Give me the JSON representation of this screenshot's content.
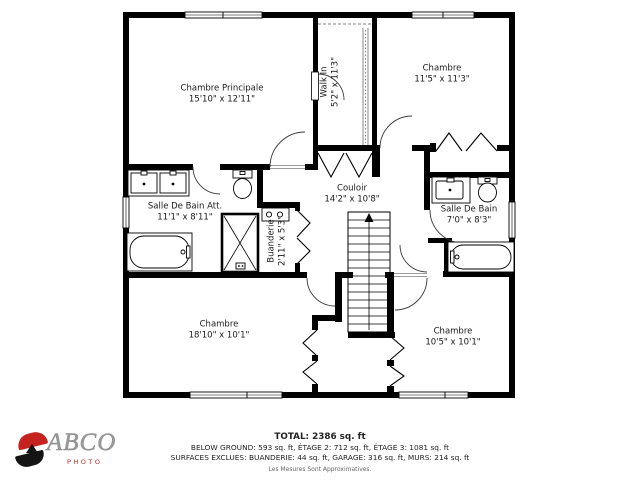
{
  "floor_plan": {
    "rooms": [
      {
        "id": "master-bedroom",
        "name": "Chambre Principale",
        "dims": "15'10\" x 12'11\""
      },
      {
        "id": "walk-in-closet",
        "name": "Walk In",
        "dims": "5'2\" x 11'3\""
      },
      {
        "id": "bedroom-top-right",
        "name": "Chambre",
        "dims": "11'5\" x 11'3\""
      },
      {
        "id": "ensuite-bathroom",
        "name": "Salle De Bain Att.",
        "dims": "11'1\" x 8'11\""
      },
      {
        "id": "hallway",
        "name": "Couloir",
        "dims": "14'2\" x 10'8\""
      },
      {
        "id": "bathroom",
        "name": "Salle De Bain",
        "dims": "7'0\" x 8'3\""
      },
      {
        "id": "laundry",
        "name": "Buanderie",
        "dims": "2'11\" x 5'3\""
      },
      {
        "id": "bedroom-bottom-left",
        "name": "Chambre",
        "dims": "18'10\" x 10'1\""
      },
      {
        "id": "bedroom-bottom-right",
        "name": "Chambre",
        "dims": "10'5\" x 10'1\""
      }
    ]
  },
  "footer": {
    "total": "TOTAL: 2386 sq. ft",
    "line2": "BELOW GROUND: 593 sq. ft, ÉTAGE 2: 712 sq. ft, ÉTAGE 3: 1081 sq. ft",
    "line3": "SURFACES EXCLUES: BUANDERIE: 44 sq. ft, GARAGE: 316 sq. ft, MURS: 214 sq. ft",
    "disclaimer": "Les Mesures Sont Approximatives."
  },
  "logo": {
    "brand": "ABCO",
    "sub": "PHOTO",
    "accent": "#c4231f"
  },
  "colors": {
    "wall": "#000000",
    "door_line": "#3a3a3a",
    "text": "#1a1a1a"
  }
}
